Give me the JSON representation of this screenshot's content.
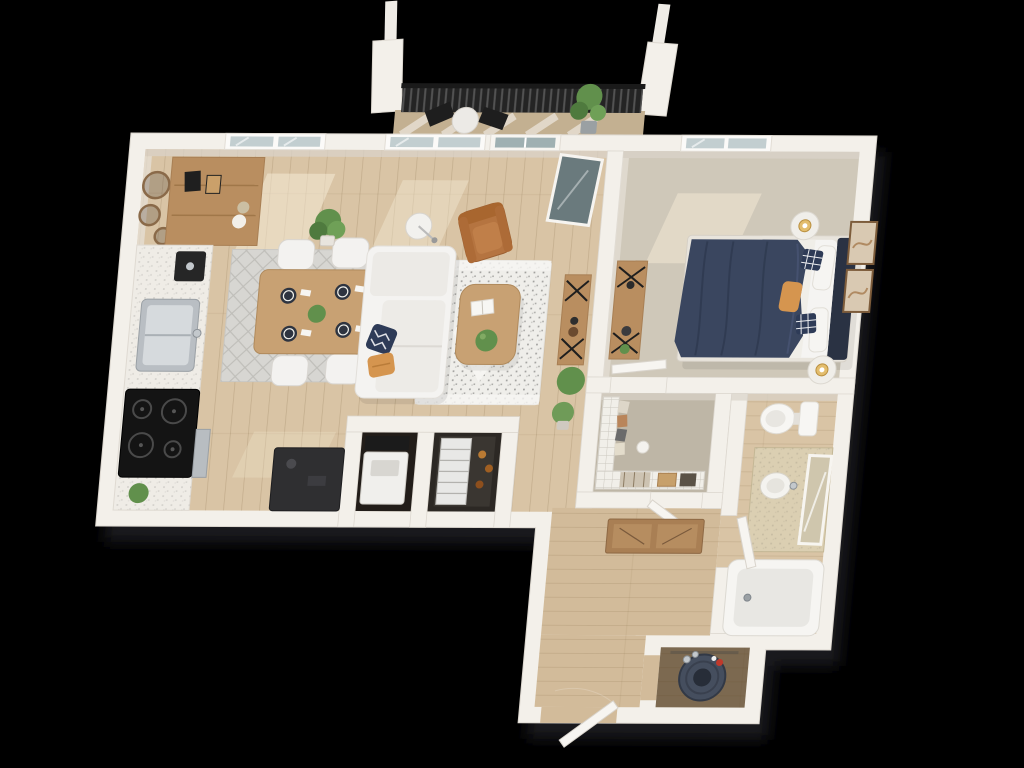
{
  "scene": {
    "type": "floor-plan-3d",
    "unit": "one-bedroom apartment with balcony",
    "view": "top-down 3d rendering on black background"
  },
  "colors": {
    "background": "#000000",
    "wall": "#f3f0ea",
    "wallFace": "#d9d3c9",
    "wood": "#d9c4a5",
    "woodHall": "#d2bb9a",
    "carpet": "#cfc8b9",
    "carpetCloset": "#beb6a6",
    "deck": "#c3b091",
    "railing": "#242424",
    "rugLiving": "#efeeea",
    "rugDining": "#d7d6d2",
    "runner": "#a97f54",
    "sofa": "#f4f3f1",
    "cushionNavy": "#2e3b57",
    "cushionOrange": "#d5954f",
    "leather": "#b57440",
    "woodFurniture": "#c8a173",
    "woodShelf": "#b98e60",
    "duvet": "#3a465f",
    "headboard": "#2a3243",
    "linen": "#f5f4f2",
    "plant": "#61904c",
    "cooktop": "#141414",
    "steel": "#c3c8cc",
    "darkBar": "#2f2f31",
    "vanity": "#dbcfb2",
    "tub": "#f6f5f2",
    "tubInner": "#e8e7e3",
    "heater": "#454e5e",
    "sun": "#f8eed9",
    "glass": "#c2ced0",
    "applianceDark": "#221d19"
  },
  "rooms": [
    {
      "id": "living-room",
      "label": "Living Room"
    },
    {
      "id": "dining-area",
      "label": "Dining Area"
    },
    {
      "id": "kitchen",
      "label": "Kitchen"
    },
    {
      "id": "bedroom",
      "label": "Bedroom"
    },
    {
      "id": "walk-in-closet",
      "label": "Walk-in Closet"
    },
    {
      "id": "bathroom",
      "label": "Bathroom"
    },
    {
      "id": "laundry-closet",
      "label": "Laundry Closet"
    },
    {
      "id": "pantry-closet",
      "label": "Pantry Closet"
    },
    {
      "id": "hallway",
      "label": "Hallway"
    },
    {
      "id": "entry",
      "label": "Entry"
    },
    {
      "id": "utility-closet",
      "label": "Utility Closet"
    },
    {
      "id": "balcony",
      "label": "Balcony"
    }
  ],
  "furniture": {
    "balcony": [
      "metal-railing",
      "bistro-table",
      "bistro-chairs",
      "planter-plant"
    ],
    "living": [
      "sectional-sofa",
      "coffee-table",
      "patterned-area-rug",
      "leather-armchair",
      "floor-lamp",
      "console-table",
      "potted-plants",
      "balcony-glass-door"
    ],
    "dining": [
      "dining-table",
      "four-chairs",
      "place-settings",
      "diamond-rug"
    ],
    "kitchen": [
      "wall-shelf",
      "round-mirror-decor",
      "countertop",
      "sink",
      "coffee-maker",
      "cooktop",
      "dark-bar-cabinet"
    ],
    "bedroom": [
      "queen-bed",
      "navy-duvet",
      "round-nightstands",
      "table-lamps",
      "x-leg-dresser",
      "wall-art-frames",
      "window"
    ],
    "closet": [
      "wire-shelving",
      "hanging-clothes",
      "baskets"
    ],
    "bathroom": [
      "toilet",
      "vanity-with-sink",
      "leaning-mirror",
      "bathtub"
    ],
    "laundry": [
      "stacked-washer-dryer"
    ],
    "pantry": [
      "wire-rack-shelves"
    ],
    "utility": [
      "water-heater"
    ],
    "entry": [
      "entry-door",
      "hall-runner-rug"
    ]
  }
}
